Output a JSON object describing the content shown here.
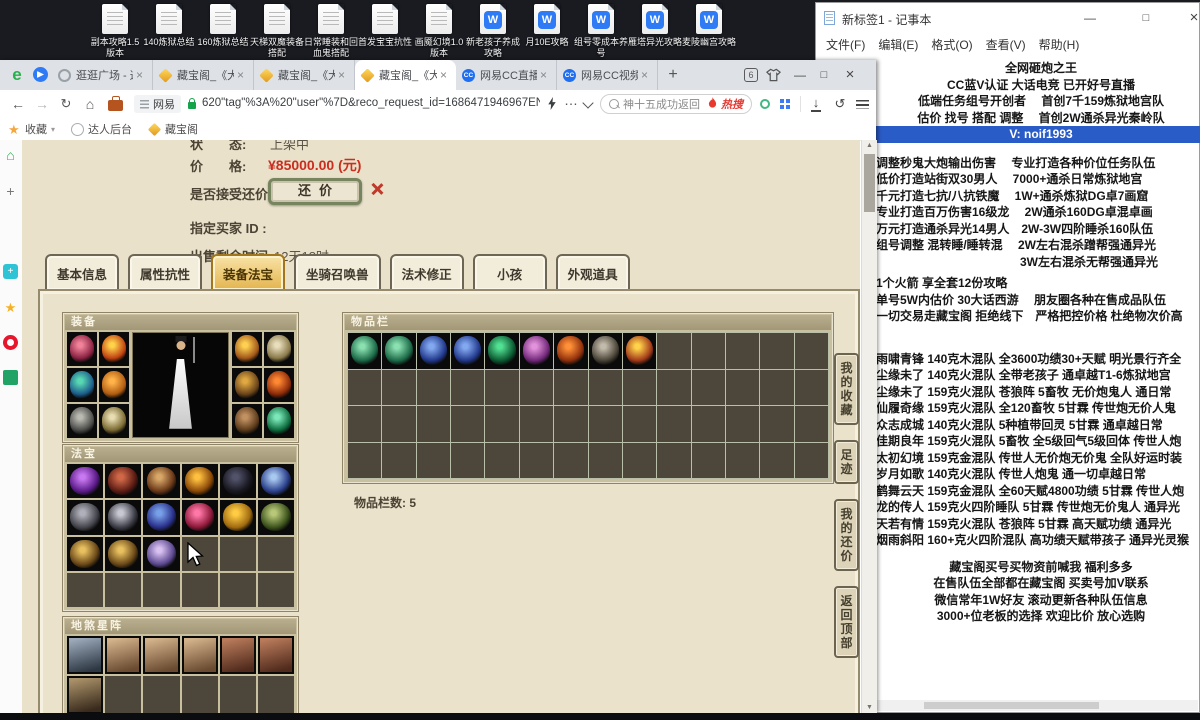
{
  "desktop": {
    "icons": [
      {
        "label": "副本攻略1.5 版本",
        "type": "txt"
      },
      {
        "label": "140炼狱总结",
        "type": "txt"
      },
      {
        "label": "160炼狱总结",
        "type": "txt"
      },
      {
        "label": "天梯双魔装备搭配",
        "type": "txt"
      },
      {
        "label": "日常睡装和回血鬼搭配",
        "type": "txt"
      },
      {
        "label": "首发宝宝抗性",
        "type": "txt"
      },
      {
        "label": "画魇幻境1.0 版本",
        "type": "txt"
      },
      {
        "label": "新老孩子养成攻略",
        "type": "wps"
      },
      {
        "label": "月10E攻略",
        "type": "wps"
      },
      {
        "label": "组号零成本养号",
        "type": "wps"
      },
      {
        "label": "雁塔异光攻略",
        "type": "wps"
      },
      {
        "label": "麦陵幽宫攻略",
        "type": "wps"
      }
    ]
  },
  "notepad": {
    "title": "新标签1 - 记事本",
    "menu": [
      "文件(F)",
      "编辑(E)",
      "格式(O)",
      "查看(V)",
      "帮助(H)"
    ],
    "lines": [
      {
        "t": "全网砸炮之王",
        "a": "c"
      },
      {
        "t": "CC蓝V认证 大话电竞 已开好号直播",
        "a": "c"
      },
      {
        "t": "低端任务组号开创者　 首创7千159炼狱地宫队",
        "a": "c"
      },
      {
        "t": "估价 找号 搭配 调整　 首创2W通杀异光秦岭队",
        "a": "c"
      },
      {
        "t": "V: noif1993",
        "a": "c",
        "hl": true
      },
      {
        "t": "",
        "a": "l",
        "gap": 12
      },
      {
        "t": "调整秒鬼大炮输出伤害　 专业打造各种价位任务队伍",
        "a": "l"
      },
      {
        "t": "低价打造站街双30男人　  7000+通杀日常炼狱地宫",
        "a": "l"
      },
      {
        "t": "千元打造七抗/八抗铁魔　 1W+通杀炼狱DG卓7画窟",
        "a": "l"
      },
      {
        "t": "专业打造百万伤害16级龙　 2W通杀160DG卓混卓画",
        "a": "l"
      },
      {
        "t": "万元打造通杀异光14男人　2W-3W四阶睡杀160队伍",
        "a": "l"
      },
      {
        "t": "组号调整 混转睡/睡转混　 2W左右混杀蹭帮强通异光",
        "a": "l"
      },
      {
        "t": "　　　　　　　　　　　　3W左右混杀无帮强通异光",
        "a": "l"
      },
      {
        "t": "",
        "a": "l",
        "gap": 5
      },
      {
        "t": "1个火箭 享全套12份攻略",
        "a": "l"
      },
      {
        "t": "单号5W内估价 30大话西游　 朋友圈各种在售成品队伍",
        "a": "l"
      },
      {
        "t": "一切交易走藏宝阁 拒绝线下　严格把控价格 杜绝物次价高",
        "a": "l"
      },
      {
        "t": "",
        "a": "l",
        "gap": 26
      },
      {
        "t": "雨啸青锋 140克木混队 全3600功绩30+天赋 明光景行齐全",
        "a": "l"
      },
      {
        "t": "尘缘未了 140克火混队 全带老孩子 通卓越T1-6炼狱地宫",
        "a": "l"
      },
      {
        "t": "尘缘未了 159克火混队 苍狼阵 5畜牧 无价炮鬼人 通日常",
        "a": "l"
      },
      {
        "t": "仙履奇缘 159克火混队 全120畜牧 5甘霖 传世炮无价人鬼",
        "a": "l"
      },
      {
        "t": "众志成城 140克火混队 5种植带回灵 5甘霖 通卓越日常",
        "a": "l"
      },
      {
        "t": "佳期良年 159克火混队 5畜牧 全5级回气5级回体 传世人炮",
        "a": "l"
      },
      {
        "t": "太初幻境 159克金混队 传世人无价炮无价鬼 全队好运时装",
        "a": "l"
      },
      {
        "t": "岁月如歌 140克火混队 传世人炮鬼 通一切卓越日常",
        "a": "l"
      },
      {
        "t": "鹤舞云天 159克金混队 全60天赋4800功绩 5甘霖 传世人炮",
        "a": "l"
      },
      {
        "t": "龙的传人 159克火四阶睡队 5甘霖 传世炮无价鬼人 通异光",
        "a": "l"
      },
      {
        "t": "天若有情 159克火混队 苍狼阵 5甘霖 高天赋功绩 通异光",
        "a": "l"
      },
      {
        "t": "烟雨斜阳 160+克火四阶混队 高功绩天赋带孩子 通异光灵猴",
        "a": "l"
      },
      {
        "t": "",
        "a": "l",
        "gap": 10
      },
      {
        "t": "藏宝阁买号买物资前喊我 福利多多",
        "a": "c"
      },
      {
        "t": "在售队伍全部都在藏宝阁 买卖号加V联系",
        "a": "c"
      },
      {
        "t": "微信常年1W好友 滚动更新各种队伍信息",
        "a": "c"
      },
      {
        "t": "3000+位老板的选择 欢迎比价 放心选购",
        "a": "c"
      }
    ]
  },
  "browser": {
    "logo": "e",
    "tabs": [
      {
        "icon": "globe",
        "title": "逛逛广场 - 这",
        "active": false
      },
      {
        "icon": "gem",
        "title": "藏宝阁_《大话",
        "active": false
      },
      {
        "icon": "gem",
        "title": "藏宝阁_《大话",
        "active": false
      },
      {
        "icon": "gem",
        "title": "藏宝阁_《大话",
        "active": true
      },
      {
        "icon": "cc",
        "title": "网易CC直播",
        "active": false
      },
      {
        "icon": "cc",
        "title": "网易CC视频_",
        "active": false
      }
    ],
    "new_tab": "+",
    "page_count": "6",
    "reader_badge": "网易",
    "url": "620\"tag\"%3A%20\"user\"%7D&reco_request_id=1686471946967ENyvd",
    "search": "神十五成功返回",
    "hot_label": "热搜",
    "bookmarks": [
      {
        "label": "收藏"
      },
      {
        "label": "达人后台"
      },
      {
        "label": "藏宝阁"
      }
    ]
  },
  "page": {
    "info": {
      "status_label": "状　　态:",
      "status_value": "上架中",
      "price_label": "价　　格:",
      "price_value": "¥85000.00 (元)",
      "bargain_label": "是否接受还价:",
      "bargain_button": "还价",
      "buyer_label": "指定买家 ID :",
      "time_label": "出售剩余时间:",
      "time_value": "12天18时"
    },
    "tabs": [
      {
        "label": "基本信息",
        "active": false
      },
      {
        "label": "属性抗性",
        "active": false
      },
      {
        "label": "装备法宝",
        "active": true
      },
      {
        "label": "坐骑召唤兽",
        "active": false
      },
      {
        "label": "法术修正",
        "active": false
      },
      {
        "label": "小孩",
        "active": false
      },
      {
        "label": "外观道具",
        "active": false
      }
    ],
    "panels": {
      "equip_title": "装备",
      "fabao_title": "法宝",
      "disha_title": "地煞星阵",
      "items_title": "物品栏",
      "items_count": "物品栏数:  5"
    },
    "sidenav": [
      {
        "label": "我的收藏"
      },
      {
        "label": "足迹"
      },
      {
        "label": "我的还价"
      },
      {
        "label": "返回顶部"
      }
    ],
    "grids": {
      "equip_left": {
        "cols": 2,
        "rows": 3,
        "filled": [
          [
            "#f08299",
            "#8a2242"
          ],
          [
            "#ffd24a",
            "#c04212"
          ],
          [
            "#58d8b2",
            "#1c5c8c"
          ],
          [
            "#ffb349",
            "#b05c12"
          ],
          [
            "#babab2",
            "#4a4a48"
          ],
          [
            "#e8ddb2",
            "#7a6a32"
          ]
        ]
      },
      "equip_right": {
        "cols": 2,
        "rows": 3,
        "filled": [
          [
            "#ffd152",
            "#a2581a"
          ],
          [
            "#e8ddbc",
            "#8a7a4a"
          ],
          [
            "#e0a842",
            "#6a441a"
          ],
          [
            "#ff8832",
            "#8c2a0a"
          ],
          [
            "#c29162",
            "#5a3a1a"
          ],
          [
            "#7ce8ba",
            "#0c6a3c"
          ]
        ]
      },
      "fabao": {
        "cols": 6,
        "rows": 4,
        "filled": [
          [
            "#c878f0",
            "#5a1a88"
          ],
          [
            "#d06848",
            "#5c1c14"
          ],
          [
            "#d8a868",
            "#6a3818"
          ],
          [
            "#ffc040",
            "#8a4808"
          ],
          [
            "#52526a",
            "#17171f"
          ],
          [
            "#a8c8f0",
            "#2a3f8a"
          ],
          [
            "#b0b0ba",
            "#44444c"
          ],
          [
            "#c8c8d2",
            "#3c3c46"
          ],
          [
            "#78a0e8",
            "#29308a"
          ],
          [
            "#ff78a8",
            "#8c1838"
          ],
          [
            "#ffcc44",
            "#a06a10"
          ],
          [
            "#b8c878",
            "#3c521c"
          ],
          [
            "#e8c060",
            "#6a4818"
          ],
          [
            "#e8c060",
            "#6a4818"
          ],
          [
            "#d8c0f0",
            "#5c4890"
          ]
        ]
      },
      "disha": {
        "cols": 6,
        "rows": 2,
        "card": true,
        "filled": [
          [
            "#9aa8b8",
            "#2e3844"
          ],
          [
            "#d2b28a",
            "#6a4a30"
          ],
          [
            "#d2b28a",
            "#6a4a30"
          ],
          [
            "#d2b28a",
            "#6a4a30"
          ],
          [
            "#b87a5a",
            "#502a1c"
          ],
          [
            "#b87a5a",
            "#502a1c"
          ],
          [
            "#a89068",
            "#382a1c"
          ]
        ]
      },
      "items": {
        "cols": 14,
        "rows": 4,
        "filled": [
          [
            "#8ae0b0",
            "#1c6a48"
          ],
          [
            "#8ae0b0",
            "#1c6a48"
          ],
          [
            "#82a8f0",
            "#22398c"
          ],
          [
            "#82a8f0",
            "#22398c"
          ],
          [
            "#52e092",
            "#0c5a32"
          ],
          [
            "#e292da",
            "#72287a"
          ],
          [
            "#ff9038",
            "#90300c"
          ],
          [
            "#c2baaa",
            "#4a4438"
          ],
          [
            "#ffd24a",
            "#a23a1a"
          ]
        ]
      }
    }
  }
}
